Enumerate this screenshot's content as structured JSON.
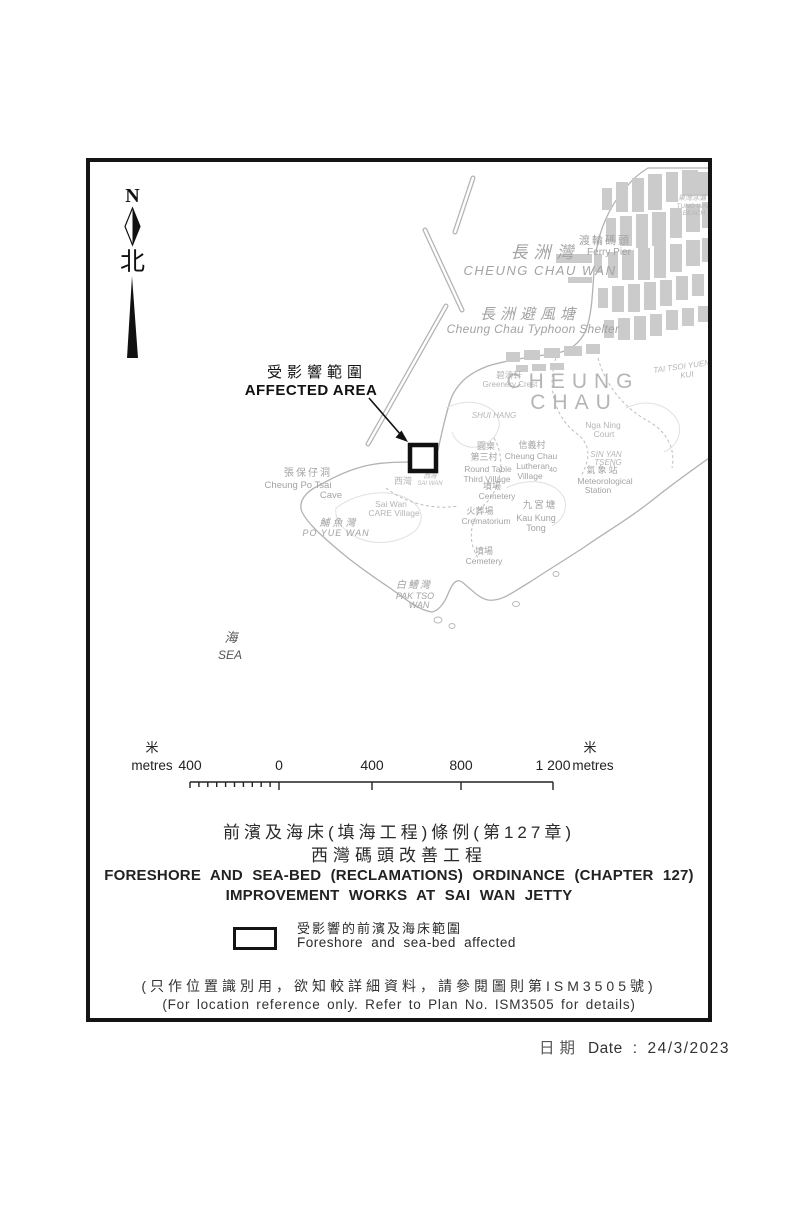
{
  "colors": {
    "ink": "#141414",
    "map_line": "#b2b2b2",
    "map_label": "#a3a3a3",
    "building": "#cbcbcb"
  },
  "north": {
    "n": "N",
    "zh": "北"
  },
  "map": {
    "labels": {
      "tung_wan_beach": {
        "zh": "東灣泳灘",
        "en1": "TUNG WAN",
        "en2": "BEACH"
      },
      "ferry_pier": {
        "zh": "渡輪碼頭",
        "en": "Ferry Pier"
      },
      "cheung_chau_wan": {
        "zh": "長洲灣",
        "en": "CHEUNG CHAU WAN"
      },
      "typhoon_shelter": {
        "zh": "長洲避風塘",
        "en": "Cheung Chau Typhoon Shelter"
      },
      "cheung_chau": {
        "l1": "CHEUNG",
        "l2": "CHAU"
      },
      "tai_tsoi_yuen": {
        "l1": "TAI TSOI YUEN",
        "l2": "KUI"
      },
      "greenery_crest": {
        "zh": "碧濤軒",
        "en": "Greenery Crest"
      },
      "shui_hang": {
        "en": "SHUI HANG"
      },
      "round_table": {
        "zh1": "圓桌",
        "zh2": "第三村",
        "en1": "Round Table",
        "en2": "Third Village"
      },
      "lutheran": {
        "zh": "信義村",
        "en1": "Cheung Chau",
        "en2": "Lutheran",
        "en3": "Village",
        "spot": "40"
      },
      "nga_ning_court": {
        "en1": "Nga Ning",
        "en2": "Court"
      },
      "sin_yan_tseng": {
        "en1": "SIN YAN",
        "en2": "TSENG"
      },
      "met_station": {
        "zh": "氣象站",
        "en1": "Meteorological",
        "en2": "Station"
      },
      "cemetery1": {
        "zh": "墳場",
        "en": "Cemetery"
      },
      "crematorium": {
        "zh": "火葬場",
        "en": "Crematorium"
      },
      "kau_kung_tong": {
        "zh": "九宮塘",
        "en1": "Kau Kung",
        "en2": "Tong"
      },
      "cemetery2": {
        "zh": "墳場",
        "en": "Cemetery"
      },
      "cheung_po_tsai": {
        "zh": "張保仔洞",
        "en1": "Cheung Po Tsai",
        "en2": "Cave"
      },
      "sai_wan_village": {
        "zh": "西灣",
        "en1": "Sai Wan",
        "en2": "CARE Village"
      },
      "sai_wan_bay": {
        "zh": "西灣",
        "en": "SAI WAN"
      },
      "po_yue_wan": {
        "zh": "鯆魚灣",
        "en": "PO YUE WAN"
      },
      "pak_tso_wan": {
        "zh": "白鰽灣",
        "en1": "PAK TSO",
        "en2": "WAN"
      },
      "sea": {
        "zh": "海",
        "en": "SEA"
      }
    }
  },
  "affected_area": {
    "zh": "受影響範圍",
    "en": "AFFECTED AREA"
  },
  "scalebar": {
    "unit_zh_left": "米",
    "unit_en_left": "metres",
    "unit_zh_right": "米",
    "unit_en_right": "metres",
    "ticks": [
      "400",
      "0",
      "400",
      "800",
      "1 200"
    ]
  },
  "title": {
    "zh1": "前濱及海床(填海工程)條例(第127章)",
    "zh2": "西灣碼頭改善工程",
    "en1": "FORESHORE AND SEA-BED (RECLAMATIONS) ORDINANCE (CHAPTER 127)",
    "en2": "IMPROVEMENT WORKS AT SAI WAN JETTY"
  },
  "legend": {
    "zh": "受影響的前濱及海床範圍",
    "en": "Foreshore and sea-bed affected"
  },
  "notes": {
    "zh": "(只作位置識別用，欲知較詳細資料，請參閱圖則第ISM3505號)",
    "en": "(For location reference only. Refer to Plan No. ISM3505 for details)"
  },
  "date": {
    "zh": "日期",
    "en": "Date",
    "sep": ":",
    "value": "24/3/2023"
  }
}
